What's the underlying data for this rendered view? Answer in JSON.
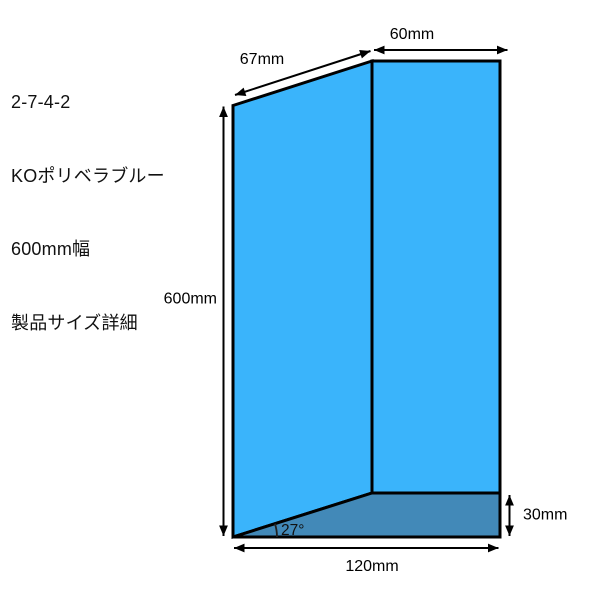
{
  "title_block": {
    "doc_number": "2-7-4-2",
    "product_name": "KOポリベラブルー",
    "width_note": "600mm幅",
    "subtitle": "製品サイズ詳細"
  },
  "diagram": {
    "labels": {
      "top_width": "60mm",
      "slant_width": "67mm",
      "height": "600mm",
      "gusset_depth": "30mm",
      "total_width": "120mm",
      "fold_angle": "27°"
    },
    "colors": {
      "panel_blue": "#3ab4fb",
      "gusset_blue": "#4289b8",
      "outline": "#000000"
    }
  }
}
